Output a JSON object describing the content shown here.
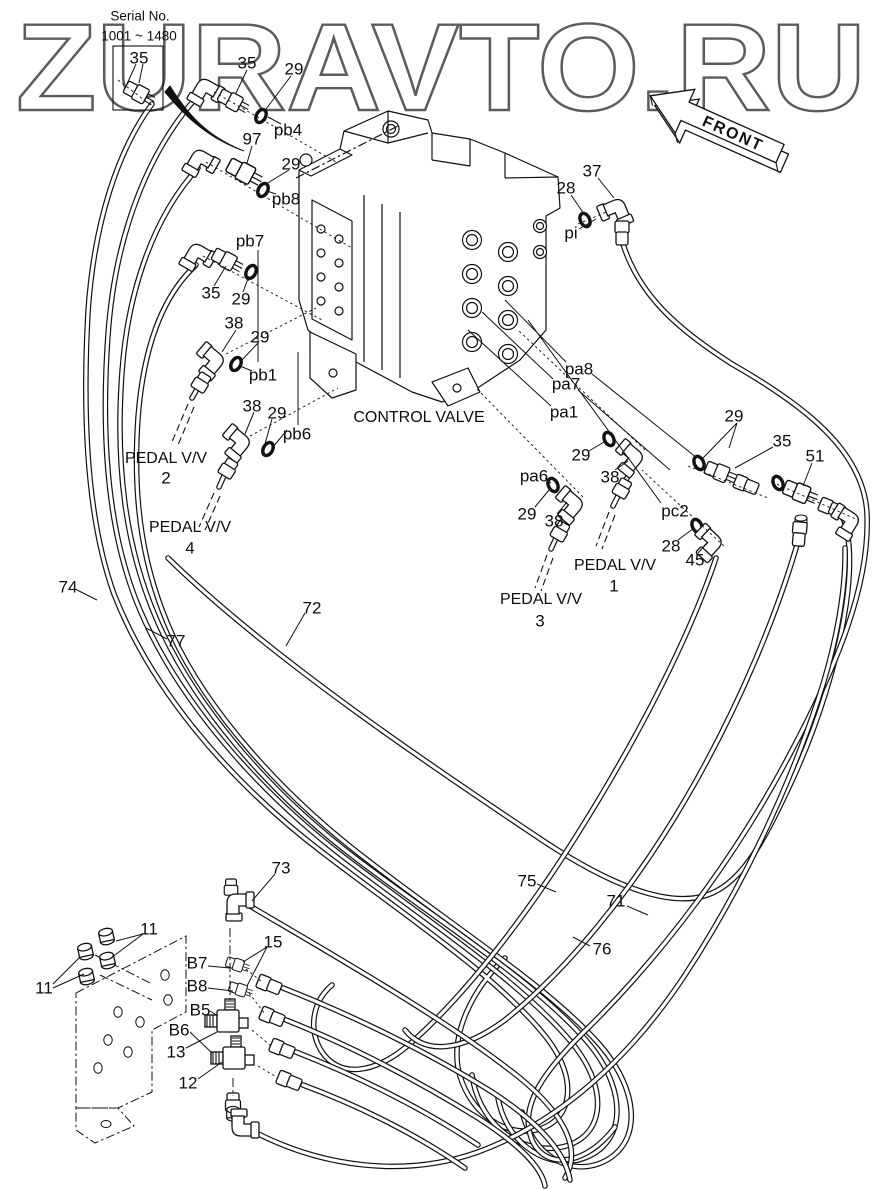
{
  "watermark": "ZURAVTO.RU",
  "front_arrow": {
    "label": "FRONT"
  },
  "colors": {
    "line": "#111111",
    "watermark_outline": "#5c5c5c",
    "background": "#ffffff"
  },
  "part_labels": [
    {
      "t": "Serial No.",
      "x": 140,
      "y": 16,
      "s": 13.5
    },
    {
      "t": "1001 ~ 1480",
      "x": 139,
      "y": 36,
      "s": 13.5
    },
    {
      "t": "35",
      "x": 139,
      "y": 58
    },
    {
      "t": "35",
      "x": 247,
      "y": 63
    },
    {
      "t": "29",
      "x": 294,
      "y": 69
    },
    {
      "t": "pb4",
      "x": 288,
      "y": 130
    },
    {
      "t": "97",
      "x": 252,
      "y": 139
    },
    {
      "t": "29",
      "x": 291,
      "y": 164
    },
    {
      "t": "pb8",
      "x": 286,
      "y": 199
    },
    {
      "t": "37",
      "x": 592,
      "y": 171
    },
    {
      "t": "28",
      "x": 566,
      "y": 188
    },
    {
      "t": "pi",
      "x": 571,
      "y": 233
    },
    {
      "t": "pb7",
      "x": 250,
      "y": 241
    },
    {
      "t": "35",
      "x": 211,
      "y": 293
    },
    {
      "t": "29",
      "x": 241,
      "y": 299
    },
    {
      "t": "38",
      "x": 234,
      "y": 323
    },
    {
      "t": "29",
      "x": 260,
      "y": 337
    },
    {
      "t": "pb1",
      "x": 263,
      "y": 375
    },
    {
      "t": "38",
      "x": 252,
      "y": 406
    },
    {
      "t": "29",
      "x": 277,
      "y": 413
    },
    {
      "t": "pb6",
      "x": 297,
      "y": 434
    },
    {
      "t": "PEDAL V/V",
      "x": 166,
      "y": 459,
      "s": 16
    },
    {
      "t": "2",
      "x": 166,
      "y": 478
    },
    {
      "t": "PEDAL V/V",
      "x": 190,
      "y": 528,
      "s": 16
    },
    {
      "t": "4",
      "x": 190,
      "y": 548
    },
    {
      "t": "CONTROL VALVE",
      "x": 419,
      "y": 418,
      "s": 16
    },
    {
      "t": "pa8",
      "x": 579,
      "y": 369
    },
    {
      "t": "pa7",
      "x": 566,
      "y": 384
    },
    {
      "t": "pa1",
      "x": 564,
      "y": 412
    },
    {
      "t": "29",
      "x": 581,
      "y": 455
    },
    {
      "t": "38",
      "x": 610,
      "y": 477
    },
    {
      "t": "pa6",
      "x": 534,
      "y": 476
    },
    {
      "t": "29",
      "x": 527,
      "y": 514
    },
    {
      "t": "38",
      "x": 554,
      "y": 521
    },
    {
      "t": "pc2",
      "x": 675,
      "y": 511
    },
    {
      "t": "28",
      "x": 671,
      "y": 546
    },
    {
      "t": "45",
      "x": 695,
      "y": 560
    },
    {
      "t": "PEDAL V/V",
      "x": 615,
      "y": 566,
      "s": 16
    },
    {
      "t": "1",
      "x": 614,
      "y": 586
    },
    {
      "t": "PEDAL V/V",
      "x": 541,
      "y": 600,
      "s": 16
    },
    {
      "t": "3",
      "x": 540,
      "y": 621
    },
    {
      "t": "29",
      "x": 734,
      "y": 416
    },
    {
      "t": "35",
      "x": 782,
      "y": 441
    },
    {
      "t": "51",
      "x": 815,
      "y": 456
    },
    {
      "t": "74",
      "x": 68,
      "y": 587
    },
    {
      "t": "77",
      "x": 176,
      "y": 641
    },
    {
      "t": "72",
      "x": 312,
      "y": 608
    },
    {
      "t": "73",
      "x": 281,
      "y": 868
    },
    {
      "t": "75",
      "x": 527,
      "y": 881
    },
    {
      "t": "71",
      "x": 616,
      "y": 901
    },
    {
      "t": "76",
      "x": 602,
      "y": 949
    },
    {
      "t": "11",
      "x": 149,
      "y": 929
    },
    {
      "t": "11",
      "x": 44,
      "y": 988
    },
    {
      "t": "15",
      "x": 273,
      "y": 942
    },
    {
      "t": "B7",
      "x": 197,
      "y": 963
    },
    {
      "t": "B8",
      "x": 197,
      "y": 986
    },
    {
      "t": "B5",
      "x": 200,
      "y": 1010
    },
    {
      "t": "B6",
      "x": 179,
      "y": 1030
    },
    {
      "t": "13",
      "x": 176,
      "y": 1052
    },
    {
      "t": "12",
      "x": 188,
      "y": 1083
    }
  ]
}
